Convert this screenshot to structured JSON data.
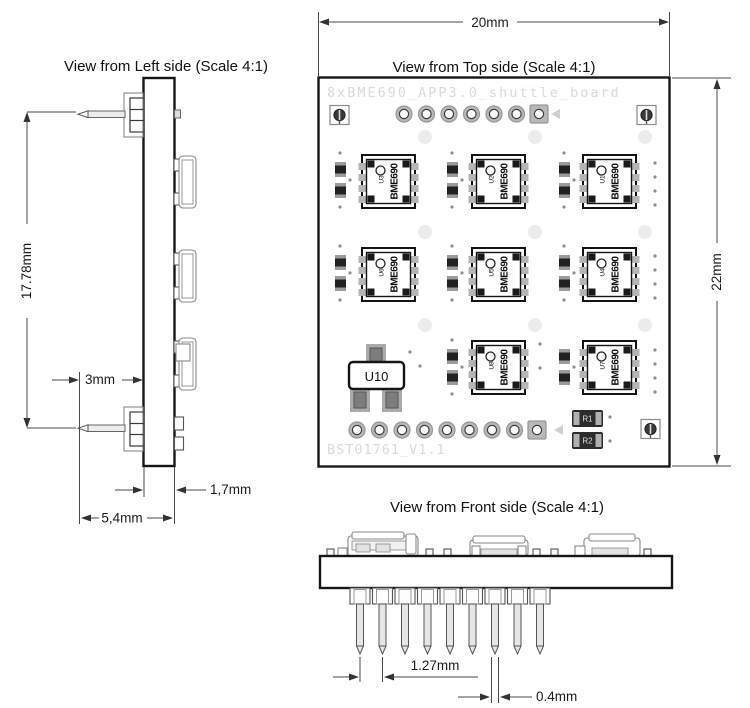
{
  "views": {
    "left": {
      "title": "View from Left side (Scale 4:1)"
    },
    "top": {
      "title": "View from Top side (Scale 4:1)",
      "silk_top": "8xBME690_APP3.0_shuttle_board",
      "silk_bottom": "BST01761_V1.1",
      "sensor_label": "BME690",
      "sensor_refs": [
        "U3",
        "U2",
        "U1",
        "U6",
        "U5",
        "U4",
        "U8",
        "U7"
      ],
      "transistor_ref": "U10",
      "resistors": [
        "R1",
        "R2"
      ]
    },
    "front": {
      "title": "View from Front side (Scale 4:1)"
    }
  },
  "dimensions": {
    "board_width": "20mm",
    "board_height": "22mm",
    "pin_span": "17.78mm",
    "pin_offset": "3mm",
    "pcb_thickness": "1,7mm",
    "overall_depth": "5,4mm",
    "pin_pitch": "1.27mm",
    "pin_width": "0.4mm"
  }
}
